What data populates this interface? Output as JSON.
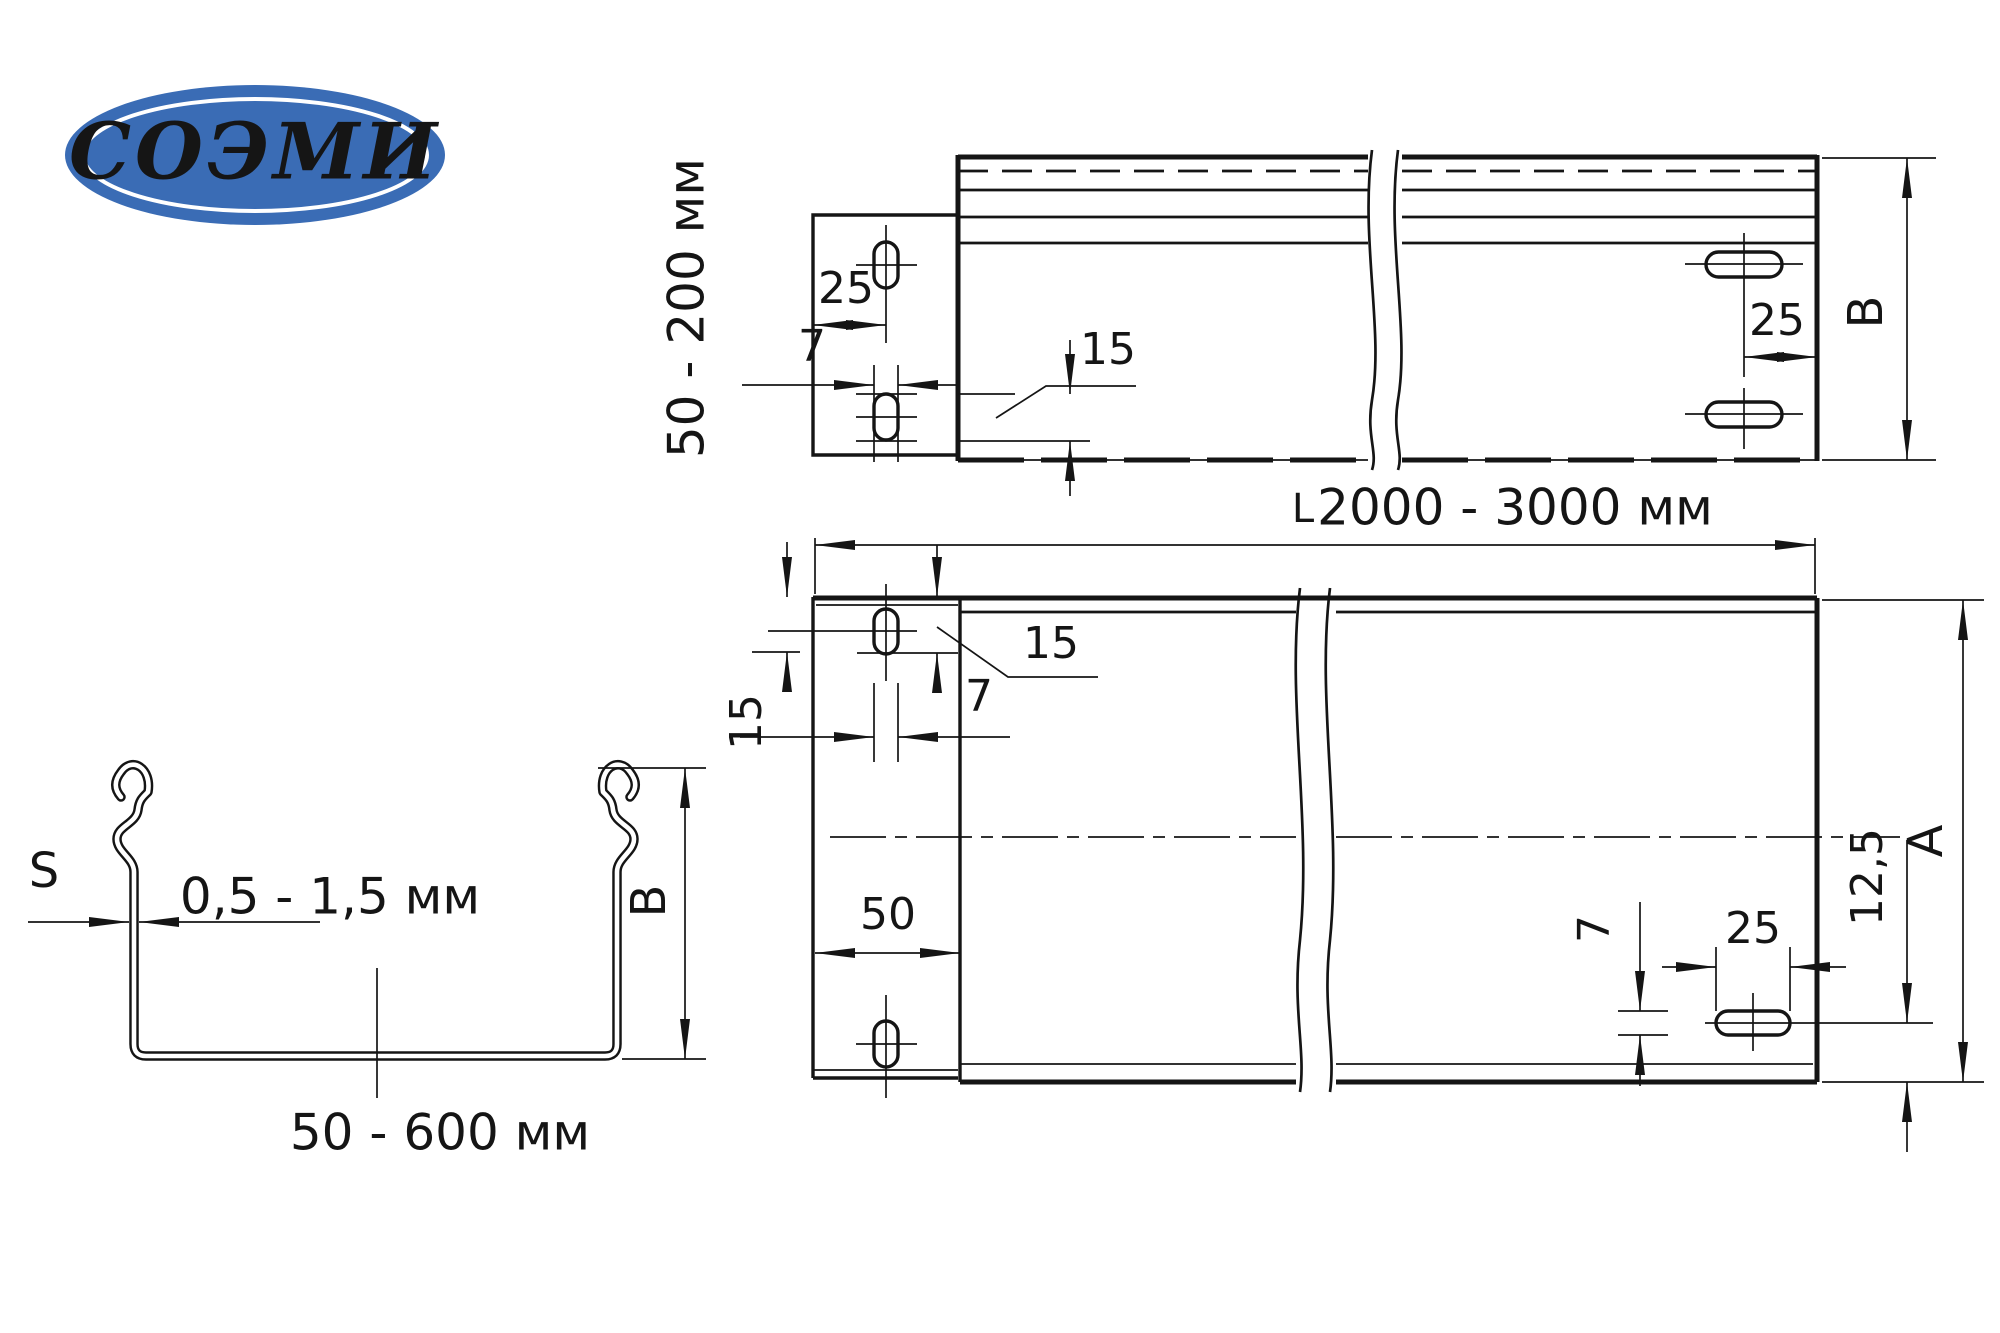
{
  "page": {
    "background": "#ffffff",
    "line_color": "#151515"
  },
  "logo": {
    "text": "СОЭМИ",
    "fill": "#3a6cb5",
    "ring_color": "#ffffff",
    "text_color": "#ffffff"
  },
  "side_view": {
    "height_range": "50 - 200 мм",
    "dim_hole_offset_left": "25",
    "dim_slot_width": "7",
    "dim_slot_length": "15",
    "dim_hole_offset_right": "25",
    "dim_height": "B"
  },
  "length_dim": {
    "prefix": "L",
    "range": "2000 - 3000 мм"
  },
  "plan_view": {
    "dim_edge_to_slot": "15",
    "dim_slot_width_left": "7",
    "dim_slot_length": "15",
    "dim_tab_width": "50",
    "dim_slot_width_right": "7",
    "dim_hole_offset": "25",
    "dim_center_offset": "12,5",
    "dim_width": "A"
  },
  "cross_section": {
    "thickness_symbol": "S",
    "thickness_range": "0,5 - 1,5 мм",
    "dim_height": "B",
    "width_range": "50 - 600 мм"
  }
}
